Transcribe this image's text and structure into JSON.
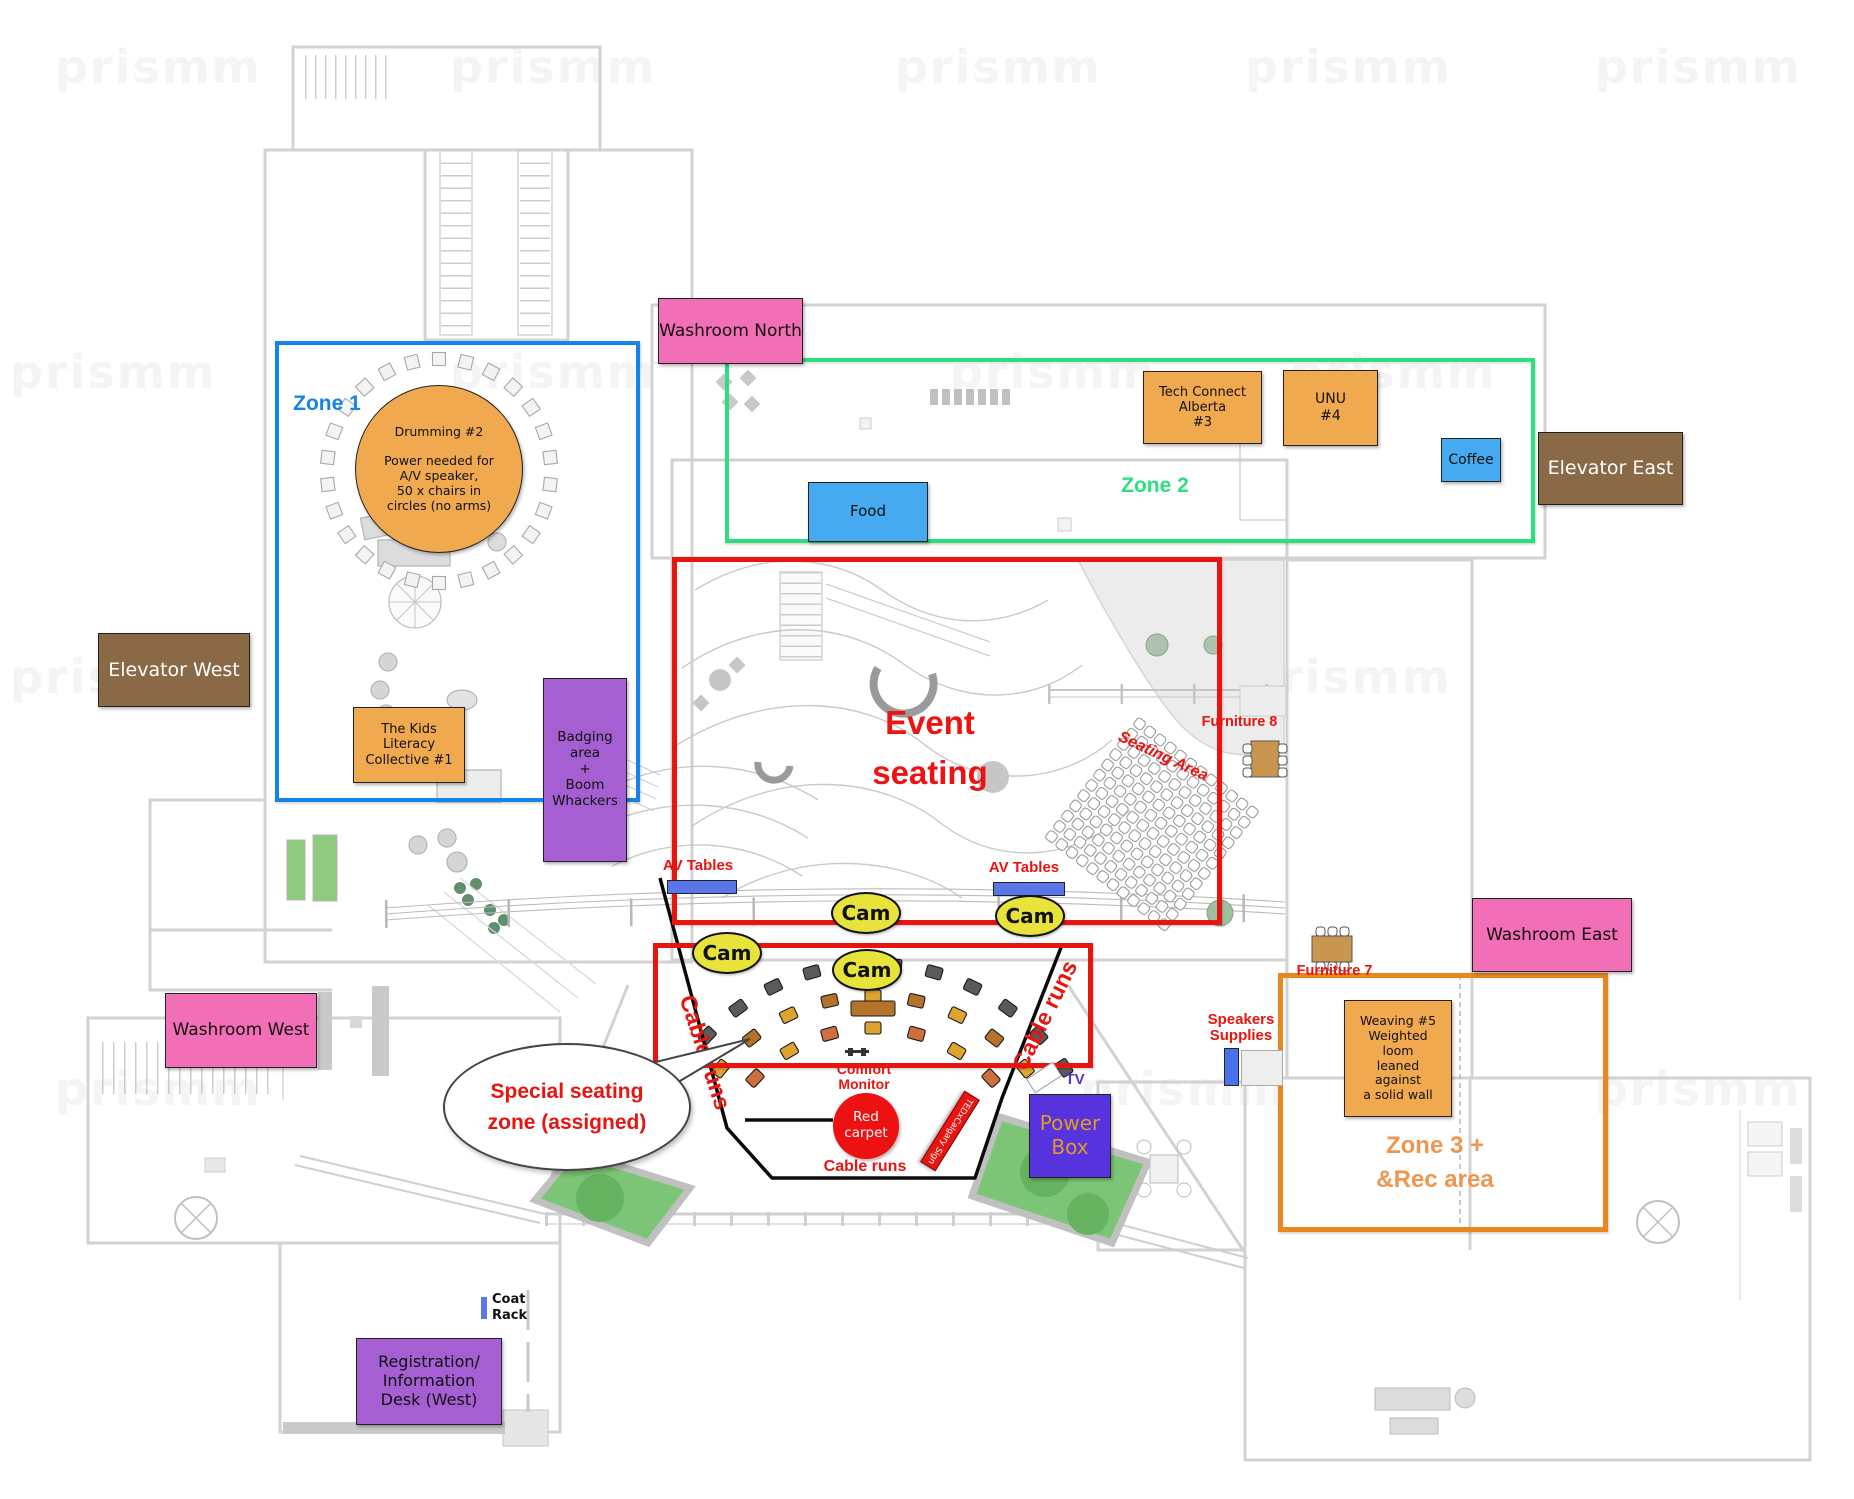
{
  "watermark": "prismm",
  "colors": {
    "zone1": "#1583ea",
    "zone2": "#2be07c",
    "zone3_border": "#e8861f",
    "zone3_text": "#f0954e",
    "annotation_red": "#e8140f",
    "station_orange": "#f0a94e",
    "room_pink": "#f26eb6",
    "elevator_brown": "#8a6a46",
    "purple": "#a55fd2",
    "service_blue": "#45aaef",
    "cam_yellow": "#e7e33b",
    "power_indigo": "#5633dd"
  },
  "zone1": {
    "label": "Zone 1"
  },
  "zone2": {
    "label": "Zone 2"
  },
  "zone3": {
    "line1": "Zone 3 +",
    "line2": "&Rec area"
  },
  "rooms": {
    "washroom_north": "Washroom North",
    "washroom_west": "Washroom West",
    "washroom_east": "Washroom East",
    "elevator_west": "Elevator West",
    "elevator_east": "Elevator East",
    "registration": "Registration/\nInformation\nDesk (West)",
    "coat_rack": "Coat\nRack"
  },
  "stations": {
    "drumming": "Drumming #2\n\nPower needed for\nA/V speaker,\n50 x chairs in\ncircles (no arms)",
    "kids_literacy": "The Kids\nLiteracy\nCollective #1",
    "badging": "Badging\narea\n+\nBoom\nWhackers",
    "tech_connect": "Tech Connect\nAlberta\n#3",
    "unu": "UNU\n#4",
    "weaving": "Weaving #5\nWeighted\nloom\nleaned\nagainst\na solid wall",
    "food": "Food",
    "coffee": "Coffee",
    "power_box": "Power\nBox",
    "tv": "TV",
    "speakers_supplies": "Speakers\nSupplies"
  },
  "event": {
    "title": "Event seating",
    "seating_area": "Seating Area",
    "special_seating": "Special seating\nzone (assigned)",
    "cam": "Cam",
    "av_tables": "AV Tables",
    "cable_runs": "Cable runs",
    "comfort_monitor": "Comfort\nMonitor",
    "red_carpet": "Red\ncarpet",
    "tedx_sign": "TEDxCalgary Sign",
    "furniture7": "Furniture 7",
    "furniture8": "Furniture 8"
  }
}
